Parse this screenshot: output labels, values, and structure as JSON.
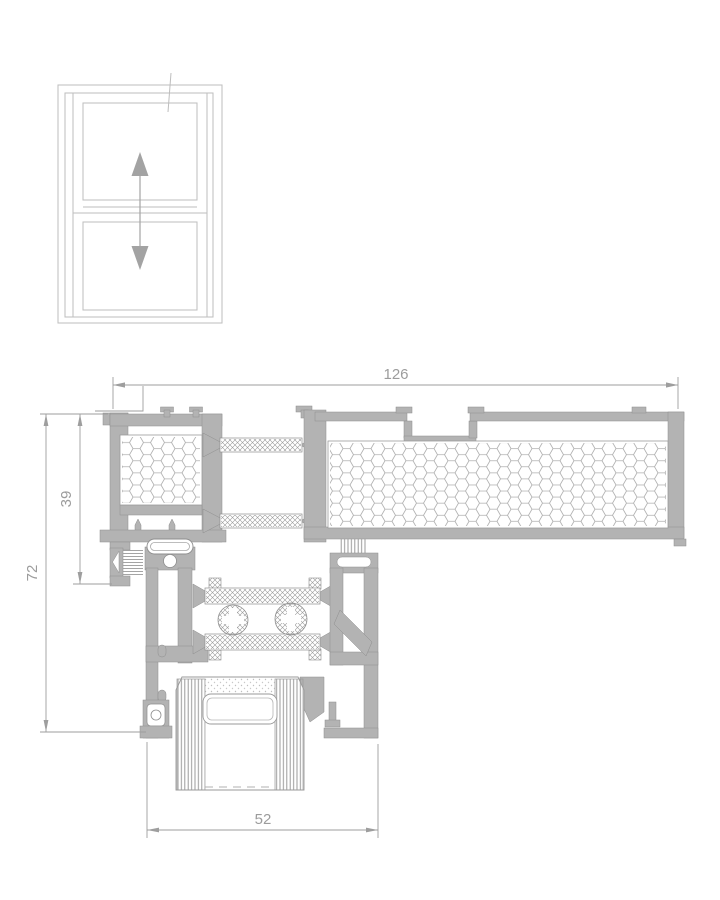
{
  "drawing": {
    "title": "window-profile-cross-section",
    "schematic": {
      "name": "vertical-slider-window",
      "movement": "up-down"
    },
    "dimensions": {
      "total_width": "126",
      "inner_height": "39",
      "total_height": "72",
      "sash_width": "52"
    },
    "colors": {
      "profile_fill": "#b3b3b3",
      "profile_edge": "#8e8e8e",
      "schematic_line": "#bdbdbd",
      "dimension_line": "#9e9e9e",
      "hatch_line": "#9a9a9a",
      "background": "#ffffff"
    }
  }
}
